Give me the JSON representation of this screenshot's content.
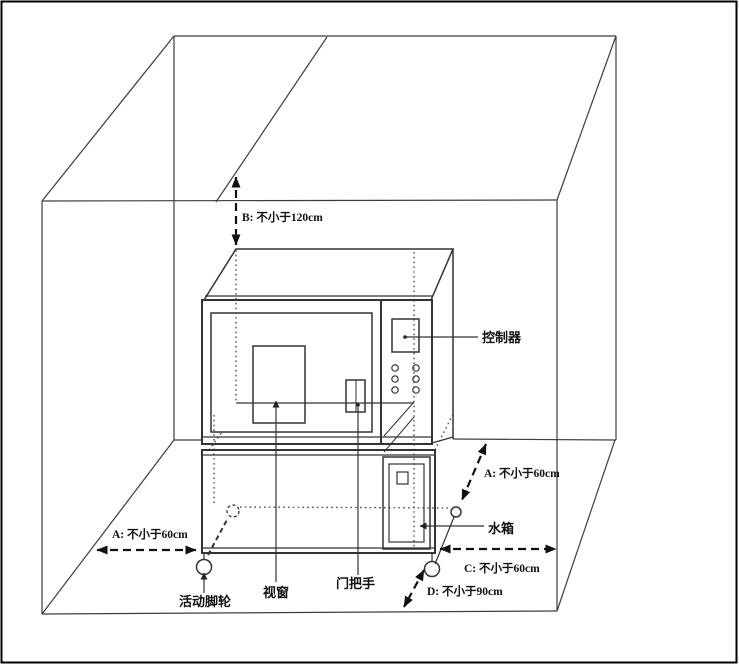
{
  "figure": {
    "kind": "equipment-installation-clearance-diagram",
    "background": "#ffffff",
    "line_color": "#2e2e2e"
  },
  "dimensions": {
    "b": {
      "id": "B",
      "label": "B: 不小于120cm"
    },
    "a_left": {
      "id": "A",
      "label": "A: 不小于60cm"
    },
    "a_right": {
      "id": "A",
      "label": "A: 不小于60cm"
    },
    "c": {
      "id": "C",
      "label": "C: 不小于60cm"
    },
    "d": {
      "id": "D",
      "label": "D: 不小于90cm"
    }
  },
  "parts": {
    "controller": {
      "label": "控制器"
    },
    "water_tank": {
      "label": "水箱"
    },
    "viewport": {
      "label": "视窗"
    },
    "door_handle": {
      "label": "门把手"
    },
    "caster": {
      "label": "活动脚轮"
    }
  }
}
